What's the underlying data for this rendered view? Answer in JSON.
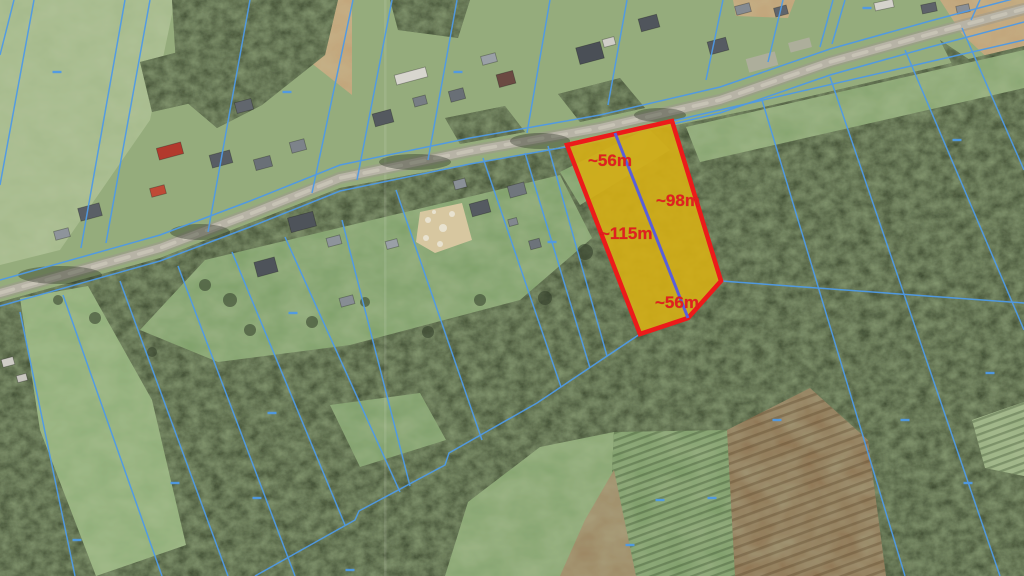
{
  "map": {
    "base_color": "#95ac7c",
    "colors": {
      "cadastral_blue": "#4f9ae6",
      "divider_blue": "#5a5fd8",
      "parcel_fill": "#d2ae17",
      "parcel_stroke": "#ec1b1b",
      "label_red": "#e02020",
      "road": "#b7b3a6",
      "road_edge": "#9d998c",
      "road_highlight": "#ccc8ba",
      "forest": "#3a462f",
      "field_light": "#a4b98b",
      "clearing": "#7fa06b",
      "brown_field": "#8d7150",
      "tan_field": "#c2a176",
      "sand": "#d7c7a0"
    },
    "labels": [
      {
        "text": "~56m",
        "x": 588,
        "y": 166
      },
      {
        "text": "~98m",
        "x": 656,
        "y": 206
      },
      {
        "text": "~115m",
        "x": 600,
        "y": 239
      },
      {
        "text": "~56m",
        "x": 655,
        "y": 308
      }
    ],
    "highlighted_parcel": {
      "polygon": [
        [
          567,
          145
        ],
        [
          672,
          121
        ],
        [
          721,
          281
        ],
        [
          688,
          318
        ],
        [
          640,
          334
        ]
      ],
      "divider": [
        [
          615,
          133
        ],
        [
          688,
          318
        ]
      ]
    },
    "road": {
      "points": [
        [
          0,
          293
        ],
        [
          160,
          248
        ],
        [
          250,
          214
        ],
        [
          340,
          178
        ],
        [
          470,
          151
        ],
        [
          600,
          128
        ],
        [
          720,
          100
        ],
        [
          830,
          62
        ],
        [
          930,
          34
        ],
        [
          1024,
          9
        ]
      ],
      "shadows": [
        [
          60,
          275,
          42,
          9
        ],
        [
          200,
          232,
          30,
          8
        ],
        [
          415,
          162,
          36,
          8
        ],
        [
          540,
          141,
          30,
          8
        ],
        [
          660,
          115,
          26,
          7
        ]
      ]
    },
    "corridor": {
      "north": [
        [
          0,
          280
        ],
        [
          160,
          235
        ],
        [
          250,
          201
        ],
        [
          340,
          165
        ],
        [
          470,
          138
        ],
        [
          600,
          115
        ],
        [
          720,
          87
        ],
        [
          830,
          49
        ],
        [
          930,
          21
        ],
        [
          1024,
          -4
        ]
      ],
      "south": [
        [
          0,
          306
        ],
        [
          160,
          261
        ],
        [
          250,
          227
        ],
        [
          340,
          191
        ],
        [
          470,
          164
        ],
        [
          600,
          141
        ],
        [
          720,
          113
        ],
        [
          830,
          75
        ],
        [
          930,
          47
        ],
        [
          1024,
          22
        ]
      ]
    },
    "cadastral_segments": [
      [
        14,
        0,
        0,
        55
      ],
      [
        34,
        0,
        0,
        185
      ],
      [
        125,
        0,
        81,
        248
      ],
      [
        150,
        0,
        106,
        243
      ],
      [
        250,
        0,
        208,
        232
      ],
      [
        353,
        0,
        312,
        193
      ],
      [
        392,
        0,
        357,
        180
      ],
      [
        457,
        0,
        428,
        160
      ],
      [
        550,
        0,
        527,
        133
      ],
      [
        627,
        0,
        608,
        105
      ],
      [
        723,
        0,
        706,
        80
      ],
      [
        783,
        0,
        768,
        62
      ],
      [
        833,
        0,
        820,
        47
      ],
      [
        845,
        0,
        832,
        44
      ],
      [
        980,
        0,
        971,
        20
      ],
      [
        20,
        312,
        75,
        576
      ],
      [
        63,
        295,
        162,
        576
      ],
      [
        120,
        281,
        228,
        576
      ],
      [
        178,
        266,
        295,
        576
      ],
      [
        232,
        252,
        345,
        525
      ],
      [
        285,
        237,
        400,
        492
      ],
      [
        342,
        220,
        410,
        486
      ],
      [
        396,
        190,
        482,
        440
      ],
      [
        483,
        158,
        561,
        387
      ],
      [
        525,
        153,
        590,
        368
      ],
      [
        548,
        146,
        607,
        356
      ],
      [
        762,
        100,
        905,
        576
      ],
      [
        830,
        77,
        1000,
        576
      ],
      [
        905,
        50,
        1024,
        330
      ],
      [
        962,
        28,
        1024,
        170
      ],
      [
        672,
        121,
        1024,
        40
      ],
      [
        721,
        281,
        1024,
        303
      ]
    ],
    "staircase": [
      [
        255,
        576
      ],
      [
        355,
        520
      ],
      [
        359,
        511
      ],
      [
        445,
        465
      ],
      [
        449,
        453
      ],
      [
        537,
        403
      ],
      [
        640,
        334
      ]
    ],
    "dashes": [
      [
        57,
        72
      ],
      [
        287,
        92
      ],
      [
        458,
        72
      ],
      [
        867,
        8
      ],
      [
        957,
        140
      ],
      [
        552,
        242
      ],
      [
        293,
        313
      ],
      [
        990,
        373
      ],
      [
        272,
        413
      ],
      [
        777,
        420
      ],
      [
        905,
        420
      ],
      [
        175,
        483
      ],
      [
        257,
        498
      ],
      [
        660,
        500
      ],
      [
        712,
        498
      ],
      [
        968,
        483
      ],
      [
        77,
        540
      ],
      [
        350,
        570
      ],
      [
        630,
        545
      ]
    ],
    "forest_main": [
      [
        0,
        302
      ],
      [
        160,
        258
      ],
      [
        340,
        188
      ],
      [
        600,
        140
      ],
      [
        672,
        126
      ],
      [
        760,
        108
      ],
      [
        1024,
        46
      ],
      [
        1024,
        576
      ],
      [
        0,
        576
      ]
    ],
    "forest_blobs": [
      [
        [
          172,
          0
        ],
        [
          338,
          0
        ],
        [
          325,
          55
        ],
        [
          262,
          105
        ],
        [
          217,
          128
        ],
        [
          178,
          95
        ]
      ],
      [
        [
          390,
          0
        ],
        [
          470,
          0
        ],
        [
          458,
          38
        ],
        [
          398,
          30
        ]
      ],
      [
        [
          140,
          62
        ],
        [
          186,
          50
        ],
        [
          196,
          102
        ],
        [
          152,
          112
        ]
      ],
      [
        [
          445,
          118
        ],
        [
          505,
          106
        ],
        [
          525,
          132
        ],
        [
          460,
          144
        ]
      ],
      [
        [
          558,
          94
        ],
        [
          620,
          78
        ],
        [
          645,
          108
        ],
        [
          580,
          122
        ]
      ],
      [
        [
          940,
          40
        ],
        [
          1024,
          96
        ],
        [
          1024,
          150
        ],
        [
          955,
          70
        ]
      ]
    ],
    "field_topleft": [
      [
        0,
        0
      ],
      [
        175,
        0
      ],
      [
        150,
        120
      ],
      [
        60,
        250
      ],
      [
        0,
        265
      ]
    ],
    "tan_patches": [
      [
        [
          940,
          0
        ],
        [
          1024,
          0
        ],
        [
          1024,
          92
        ],
        [
          962,
          34
        ]
      ],
      [
        [
          733,
          0
        ],
        [
          795,
          0
        ],
        [
          788,
          18
        ],
        [
          736,
          16
        ]
      ],
      [
        [
          293,
          0
        ],
        [
          352,
          0
        ],
        [
          352,
          95
        ],
        [
          310,
          62
        ]
      ]
    ],
    "clearings": [
      {
        "pts": [
          [
            140,
            330
          ],
          [
            205,
            260
          ],
          [
            560,
            175
          ],
          [
            592,
            238
          ],
          [
            520,
            300
          ],
          [
            350,
            345
          ],
          [
            218,
            362
          ]
        ],
        "fill": "#7fa06b"
      },
      {
        "pts": [
          [
            20,
            298
          ],
          [
            88,
            286
          ],
          [
            152,
            400
          ],
          [
            186,
            545
          ],
          [
            96,
            576
          ],
          [
            40,
            430
          ]
        ],
        "fill": "#8fae78"
      },
      {
        "pts": [
          [
            330,
            405
          ],
          [
            420,
            393
          ],
          [
            446,
            440
          ],
          [
            360,
            467
          ]
        ],
        "fill": "#7d9e69"
      },
      {
        "pts": [
          [
            445,
            576
          ],
          [
            468,
            502
          ],
          [
            540,
            447
          ],
          [
            614,
            432
          ],
          [
            612,
            470
          ],
          [
            636,
            576
          ]
        ],
        "fill": "#85a470"
      },
      {
        "pts": [
          [
            612,
            470
          ],
          [
            614,
            432
          ],
          [
            727,
            430
          ],
          [
            762,
            545
          ],
          [
            758,
            576
          ],
          [
            636,
            576
          ]
        ],
        "fill": "#7b9c67",
        "stripes": true
      },
      {
        "pts": [
          [
            585,
            520
          ],
          [
            614,
            470
          ],
          [
            636,
            576
          ],
          [
            560,
            576
          ]
        ],
        "fill": "#9b8461"
      },
      {
        "pts": [
          [
            972,
            420
          ],
          [
            1024,
            402
          ],
          [
            1024,
            476
          ],
          [
            985,
            468
          ]
        ],
        "fill": "#9ab183",
        "stripes": true
      },
      {
        "pts": [
          [
            560,
            172
          ],
          [
            648,
            128
          ],
          [
            670,
            150
          ],
          [
            580,
            205
          ]
        ],
        "fill": "#7fa06b"
      },
      {
        "pts": [
          [
            686,
            127
          ],
          [
            1024,
            50
          ],
          [
            1024,
            88
          ],
          [
            700,
            162
          ]
        ],
        "fill": "#87a571"
      }
    ],
    "brown_field": {
      "pts": [
        [
          727,
          430
        ],
        [
          810,
          388
        ],
        [
          868,
          440
        ],
        [
          886,
          576
        ],
        [
          735,
          576
        ]
      ]
    },
    "sand_lot": [
      [
        420,
        212
      ],
      [
        462,
        203
      ],
      [
        472,
        240
      ],
      [
        435,
        253
      ],
      [
        416,
        242
      ]
    ],
    "sand_spots": [
      [
        428,
        220,
        3
      ],
      [
        443,
        228,
        4
      ],
      [
        452,
        214,
        3
      ],
      [
        426,
        238,
        3
      ],
      [
        440,
        244,
        3
      ],
      [
        434,
        212,
        2
      ]
    ],
    "trees": [
      [
        230,
        300,
        7
      ],
      [
        312,
        322,
        6
      ],
      [
        152,
        352,
        5
      ],
      [
        428,
        332,
        6
      ],
      [
        365,
        302,
        5
      ],
      [
        585,
        252,
        8
      ],
      [
        545,
        298,
        7
      ],
      [
        480,
        300,
        6
      ],
      [
        95,
        318,
        6
      ],
      [
        58,
        300,
        5
      ],
      [
        205,
        285,
        6
      ],
      [
        250,
        330,
        6
      ]
    ],
    "driveways": [
      [
        762,
        62,
        30,
        14,
        -15
      ],
      [
        800,
        45,
        22,
        10,
        -15
      ]
    ],
    "houses": [
      [
        90,
        212,
        22,
        13,
        -15,
        "#5a5f66"
      ],
      [
        62,
        234,
        15,
        9,
        -15,
        "#8e949b"
      ],
      [
        170,
        151,
        25,
        12,
        -15,
        "#b23a2d"
      ],
      [
        158,
        191,
        15,
        9,
        -15,
        "#bf4a36"
      ],
      [
        221,
        159,
        21,
        13,
        -15,
        "#585d64"
      ],
      [
        263,
        163,
        17,
        11,
        -15,
        "#6a7077"
      ],
      [
        298,
        146,
        15,
        11,
        -15,
        "#7d838a"
      ],
      [
        244,
        106,
        17,
        11,
        -15,
        "#61666d"
      ],
      [
        302,
        222,
        26,
        15,
        -15,
        "#4e535a"
      ],
      [
        334,
        241,
        14,
        9,
        -15,
        "#8e949b"
      ],
      [
        383,
        118,
        19,
        13,
        -15,
        "#54595f"
      ],
      [
        411,
        76,
        32,
        10,
        -15,
        "#d8d6cf"
      ],
      [
        420,
        101,
        13,
        9,
        -15,
        "#777d84"
      ],
      [
        457,
        95,
        15,
        11,
        -15,
        "#696f76"
      ],
      [
        506,
        79,
        17,
        13,
        -15,
        "#6b4a42"
      ],
      [
        489,
        59,
        15,
        9,
        -15,
        "#9aa0a7"
      ],
      [
        590,
        53,
        25,
        17,
        -15,
        "#4a4f56"
      ],
      [
        609,
        42,
        12,
        8,
        -15,
        "#d0cec8"
      ],
      [
        649,
        23,
        19,
        13,
        -15,
        "#50555c"
      ],
      [
        718,
        46,
        19,
        13,
        -15,
        "#565b62"
      ],
      [
        743,
        9,
        15,
        9,
        -15,
        "#858b92"
      ],
      [
        781,
        11,
        13,
        9,
        -15,
        "#5f646b"
      ],
      [
        884,
        5,
        19,
        8,
        -12,
        "#d5d3cc"
      ],
      [
        929,
        8,
        15,
        9,
        -12,
        "#5d6269"
      ],
      [
        963,
        9,
        13,
        8,
        -12,
        "#898f96"
      ],
      [
        266,
        267,
        21,
        15,
        -15,
        "#4e535a"
      ],
      [
        347,
        301,
        14,
        9,
        -15,
        "#878d94"
      ],
      [
        392,
        244,
        12,
        8,
        -15,
        "#9aa0a7"
      ],
      [
        460,
        184,
        12,
        9,
        -15,
        "#8a9097"
      ],
      [
        480,
        208,
        19,
        13,
        -15,
        "#555a61"
      ],
      [
        517,
        190,
        17,
        12,
        -15,
        "#70767d"
      ],
      [
        513,
        222,
        9,
        7,
        -15,
        "#82888f"
      ],
      [
        535,
        244,
        11,
        9,
        -15,
        "#6d737a"
      ],
      [
        8,
        362,
        12,
        8,
        -15,
        "#cfcdc6"
      ],
      [
        22,
        378,
        10,
        7,
        -15,
        "#c8c6bf"
      ]
    ],
    "seam_x": 384
  }
}
